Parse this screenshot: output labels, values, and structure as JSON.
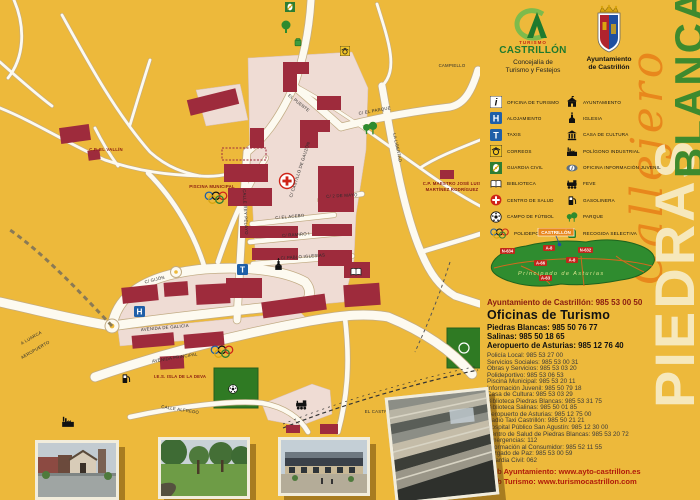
{
  "edge": {
    "script_title": "Callejero",
    "place_word_big": "PIEDRAS",
    "place_word_green": "BLANCAS"
  },
  "logos": {
    "turismo_small": "TURISMO",
    "turismo_name": "CASTRILLÓN",
    "turismo_sub1": "Concejalía de",
    "turismo_sub2": "Turismo y Festejos",
    "ayto_line1": "Ayuntamiento",
    "ayto_line2": "de Castrillón"
  },
  "legend": {
    "left": [
      {
        "icon": "tourism-office-icon",
        "label": "OFICINA DE TURISMO"
      },
      {
        "icon": "lodging-icon",
        "label": "ALOJAMIENTO"
      },
      {
        "icon": "taxi-icon",
        "label": "TAXIS"
      },
      {
        "icon": "post-office-icon",
        "label": "CORREOS"
      },
      {
        "icon": "guardia-civil-icon",
        "label": "GUARDIA CIVIL"
      },
      {
        "icon": "library-icon",
        "label": "BIBLIOTECA"
      },
      {
        "icon": "health-center-icon",
        "label": "CENTRO DE SALUD"
      },
      {
        "icon": "football-field-icon",
        "label": "CAMPO DE FÚTBOL"
      },
      {
        "icon": "sports-rings-icon",
        "label": "POLIDEPORTIVO"
      }
    ],
    "right": [
      {
        "icon": "town-hall-icon",
        "label": "AYUNTAMIENTO"
      },
      {
        "icon": "church-icon",
        "label": "IGLESIA"
      },
      {
        "icon": "culture-house-icon",
        "label": "CASA DE CULTURA"
      },
      {
        "icon": "factory-icon",
        "label": "POLÍGONO INDUSTRIAL"
      },
      {
        "icon": "youth-info-icon",
        "label": "OFICINA INFORMACIÓN JUVENIL"
      },
      {
        "icon": "train-icon",
        "label": "FEVE"
      },
      {
        "icon": "fuel-pump-icon",
        "label": "GASOLINERA"
      },
      {
        "icon": "park-icon",
        "label": "PARQUE"
      },
      {
        "icon": "recycling-icon",
        "label": "RECOGIDA SELECTIVA"
      }
    ]
  },
  "asturias": {
    "region_label": "Principado de Asturias",
    "town_label": "CASTRILLÓN",
    "road_labels": [
      "N-634",
      "A-8",
      "N-632",
      "A-66",
      "A-8",
      "A-63"
    ]
  },
  "contact": {
    "ayto_line": "Ayuntamiento de Castrillón: 985 53 00 50",
    "turismo_title": "Oficinas de Turismo",
    "turismo_lines": [
      "Piedras Blancas: 985 50 76 77",
      "Salinas: 985 50 18 65",
      "Aeropuerto de Asturias: 985 12 76 40"
    ]
  },
  "phones": [
    "Policía Local: 985 53 27 00",
    "Servicios Sociales: 985 53 00 31",
    "Obras y Servicios: 985 53 03 20",
    "Polideportivo: 985 53 06 53",
    "Piscina Municipal: 985 53 20 11",
    "Información Juvenil: 985 50 79 18",
    "Casa de Cultura: 985 53 03 29",
    "Biblioteca Piedras Blancas: 985 53 31 75",
    "Biblioteca Salinas: 985 50 01 85",
    "Aeropuerto de Asturias: 985 12 75 00",
    "Radio Taxi Castrillón: 985 50 21 21",
    "Hospital Público San Agustín: 985 12 30 00",
    "Centro de Salud de Piedras Blancas: 985 53 20 72",
    "Emergencias: 112",
    "Información al Consumidor: 985 52 11 55",
    "Juzgado de Paz: 985 53 00 59",
    "Guardia Civil: 062"
  ],
  "webs": [
    "web Ayuntamiento: www.ayto-castrillon.es",
    "web Turismo: www.turismocastrillon.com"
  ],
  "map": {
    "street_labels": [
      "CAMPIELLO",
      "C/ EL PARQUE",
      "LA LIBERTAD",
      "CALLE REY PELAYO",
      "C/ EL ACEBO",
      "C/ RAMIRO I",
      "C/ PABLO IGLESIAS",
      "C/ GIJÓN",
      "AVENIDA DE GALICIA",
      "AVENIDA PRINCIPAL",
      "CALLE ALFREDO",
      "A LUARCA",
      "AEROPUERTO",
      "EL CASTRO",
      "EL PUENTE",
      "C/ CASTILLO DE GAUZÓN",
      "C/ 2 DE MAYO"
    ],
    "poi_labels": [
      "C.P. EL VALLÍN",
      "C.P. MAESTRO JOSÉ LUIS",
      "MARTÍNEZ RODRÍGUEZ",
      "I.E.S. ISLA DE LA DEVA",
      "PISCINA MUNICIPAL"
    ],
    "colors": {
      "background": "#EDB93B",
      "street": "#FDFAF0",
      "block": "#EFDCD4",
      "building": "#9E2B3C",
      "green": "#2F7A23"
    }
  }
}
